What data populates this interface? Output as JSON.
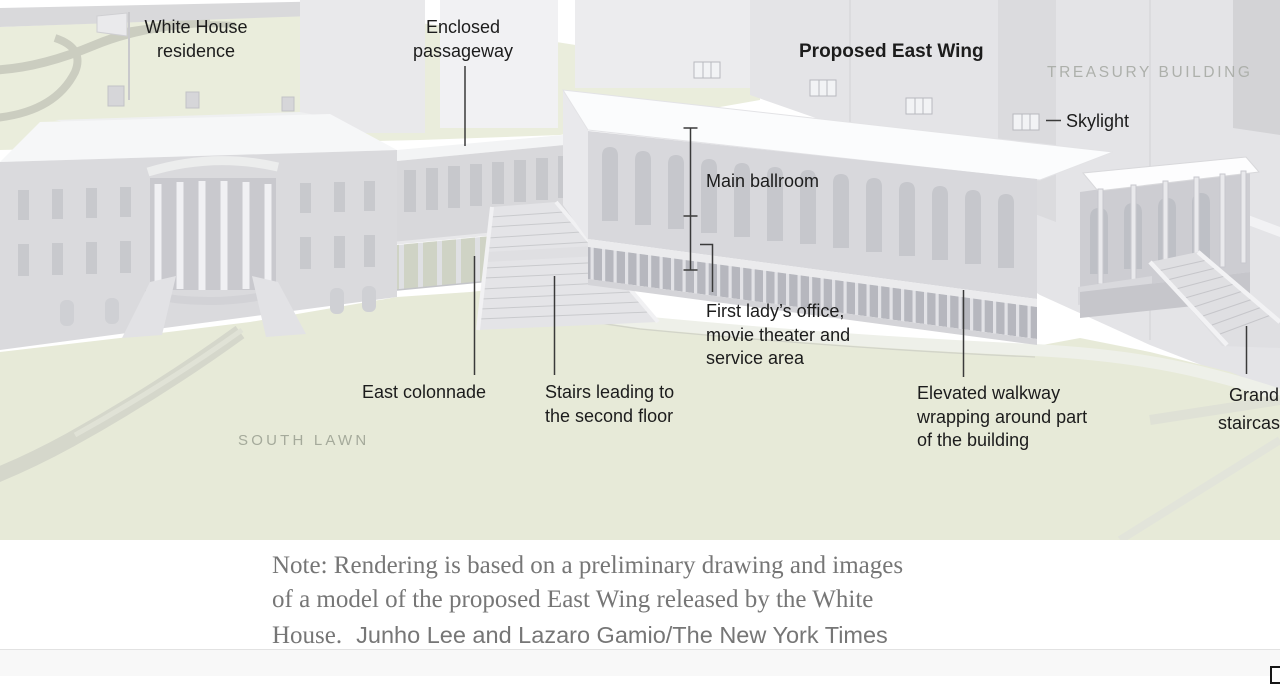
{
  "annotations": {
    "white_house": {
      "line1": "White House",
      "line2": "residence"
    },
    "enclosed_passageway": {
      "line1": "Enclosed",
      "line2": "passageway"
    },
    "proposed_east_wing": {
      "text": "Proposed East Wing"
    },
    "treasury_building": {
      "text": "TREASURY BUILDING"
    },
    "skylight": {
      "text": "Skylight"
    },
    "main_ballroom": {
      "text": "Main ballroom"
    },
    "first_lady": {
      "line1": "First lady’s office,",
      "line2": "movie theater and",
      "line3": "service area"
    },
    "east_colonnade": {
      "text": "East colonnade"
    },
    "stairs": {
      "line1": "Stairs leading to",
      "line2": "the second floor"
    },
    "elevated_walkway": {
      "line1": "Elevated walkway",
      "line2": "wrapping around part",
      "line3": "of the building"
    },
    "grand_staircase": {
      "line1": "Grand",
      "line2": "staircase"
    },
    "south_lawn": {
      "text": "SOUTH LAWN"
    }
  },
  "note": {
    "line1": "Note: Rendering is based on a preliminary drawing and images",
    "line2": "of a model of the proposed East Wing released by the White",
    "line3_text": "House.",
    "line3_credit": "Junho Lee and Lazaro Gamio/The New York Times"
  },
  "colors": {
    "lawn_north": "#eaeddc",
    "lawn_south": "#e7ead8",
    "path": "#d5d7cb",
    "path_light": "#eef0e9",
    "building_light": "#ececee",
    "building_mid": "#d9d9dc",
    "building_shadow": "#b9bac0",
    "roof_white": "#fbfcfd",
    "label_text": "#1c1c1c",
    "muted_caps": "#adb0ab",
    "lawn_caps": "#a5aa9b",
    "note_text": "#767676",
    "leader_line": "#3a3a3a"
  }
}
